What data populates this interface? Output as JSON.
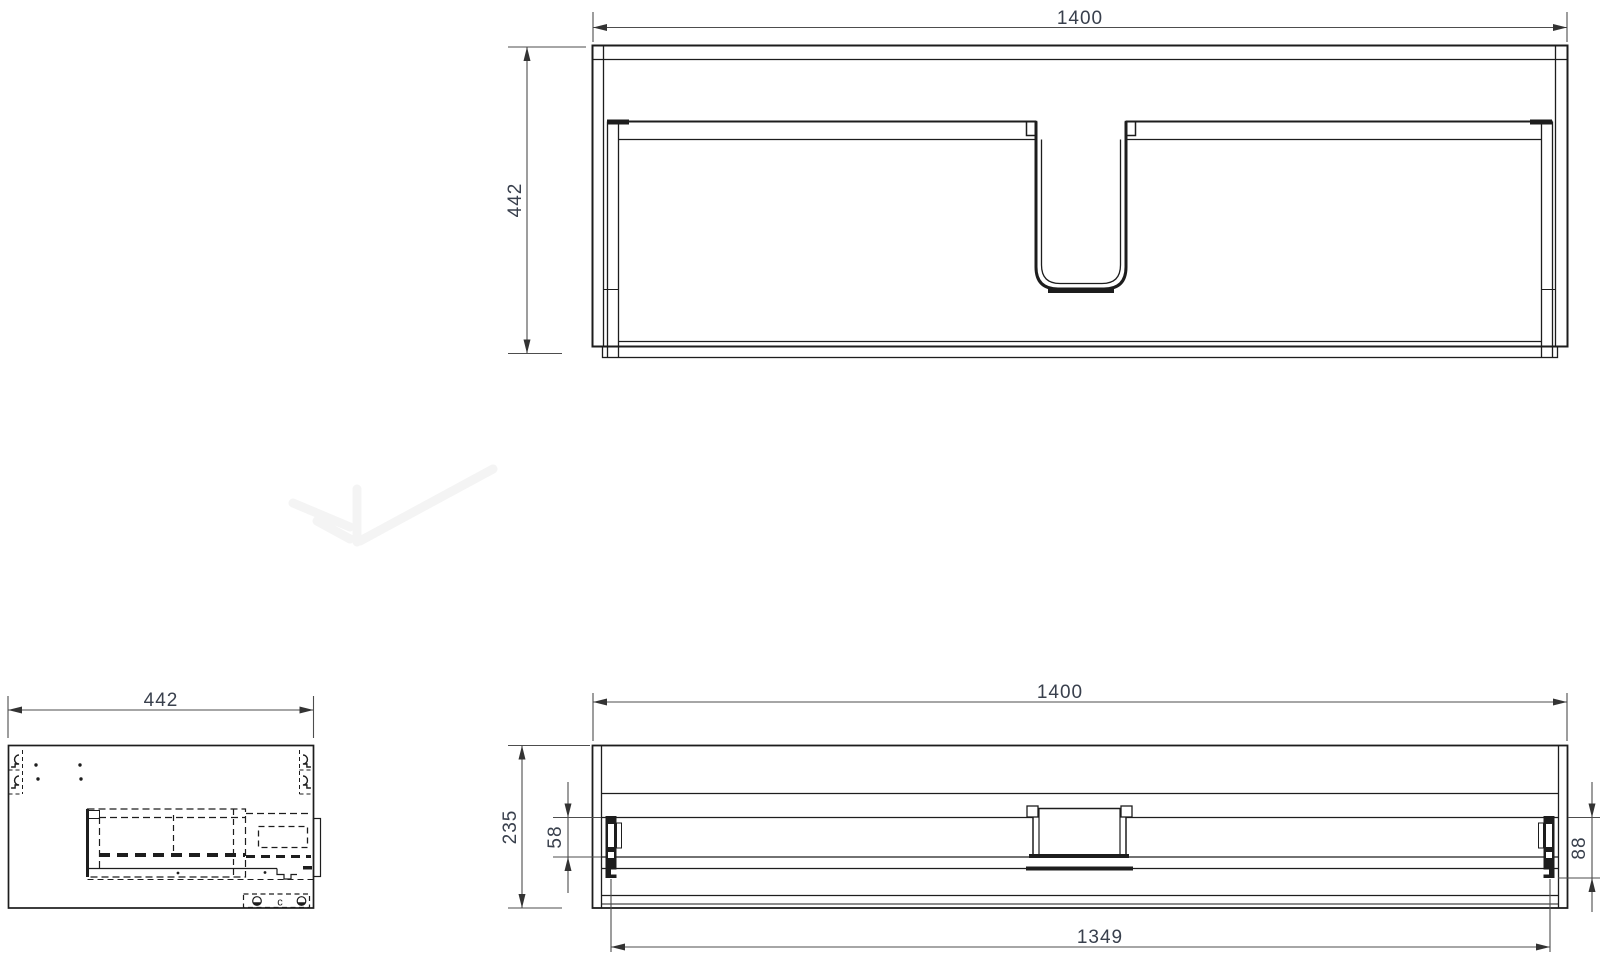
{
  "drawing": {
    "plan_view": {
      "width_dim": "1400",
      "depth_dim": "442"
    },
    "side_view": {
      "depth_dim": "442",
      "hardware_label": "c"
    },
    "front_view": {
      "width_dim": "1400",
      "height_dim": "235",
      "rail_dim": "58",
      "bracket_dim": "88",
      "inner_width_dim": "1349"
    }
  },
  "colors": {
    "background": "#ffffff",
    "line": "#1d1d1d",
    "dim_line": "#4d4d4d",
    "dim_text": "#39404d",
    "watermark": "#f4f4f4"
  }
}
